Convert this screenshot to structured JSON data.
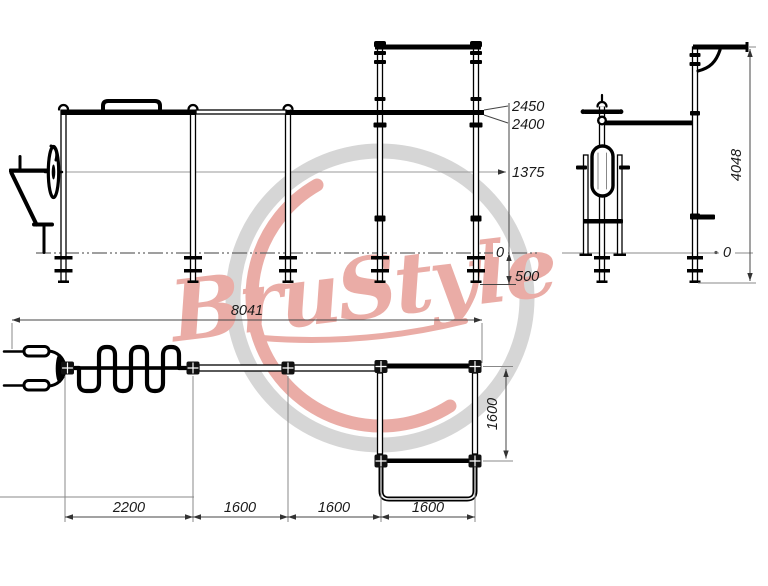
{
  "watermark": {
    "brand": "BruStyle",
    "accent_color": "#d96a5e",
    "ring_color": "#b6b6b6"
  },
  "front_view": {
    "dims": {
      "bar_top": "2450",
      "bar_bottom": "2400",
      "mid_level": "1375",
      "ground": "0",
      "foundation_depth": "500"
    }
  },
  "side_view": {
    "dims": {
      "total_height": "4048",
      "ground": "0"
    }
  },
  "plan_view": {
    "dims": {
      "overall_length": "8041",
      "square_depth": "1600",
      "bays": [
        "2200",
        "1600",
        "1600",
        "1600"
      ]
    }
  }
}
